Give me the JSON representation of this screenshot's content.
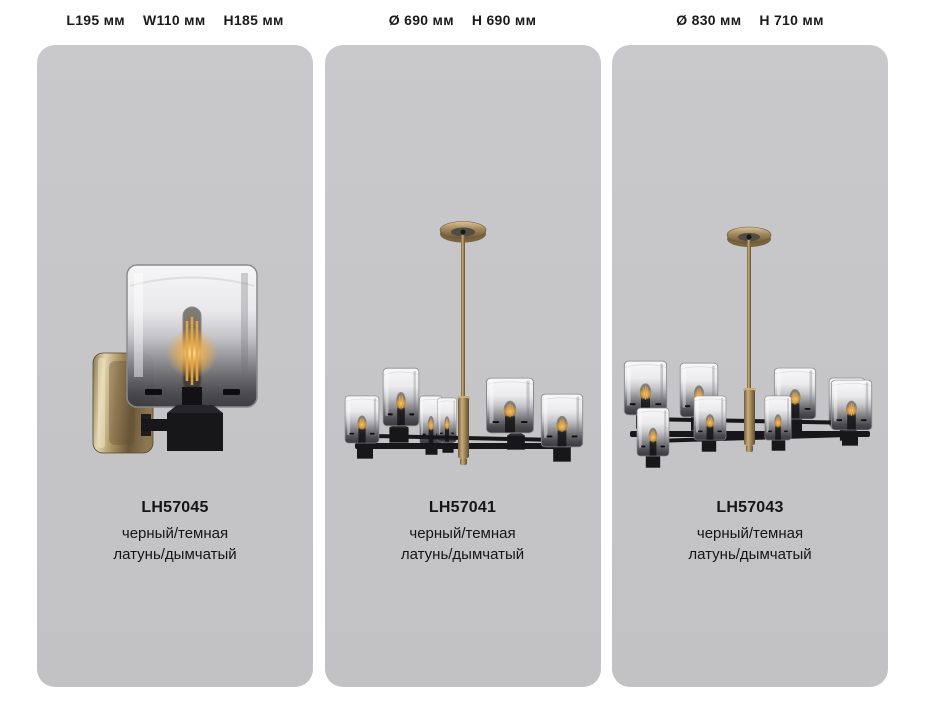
{
  "page": {
    "background_color": "#ffffff",
    "card_background_color": "#c6c6c8"
  },
  "products": [
    {
      "image": "wall-sconce-one-light",
      "dimensions": [
        "L195 мм",
        "W110 мм",
        "H185 мм"
      ],
      "code": "LH57045",
      "finish_line1": "черный/темная",
      "finish_line2": "латунь/дымчатый"
    },
    {
      "image": "chandelier-six-light",
      "dimensions": [
        "Ø 690 мм",
        "H 690 мм"
      ],
      "code": "LH57041",
      "finish_line1": "черный/темная",
      "finish_line2": "латунь/дымчатый"
    },
    {
      "image": "chandelier-eight-light",
      "dimensions": [
        "Ø 830 мм",
        "H 710 мм"
      ],
      "code": "LH57043",
      "finish_line1": "черный/темная",
      "finish_line2": "латунь/дымчатый"
    }
  ],
  "colors": {
    "text": "#1b1b1d",
    "brass": "#9c8254",
    "brass_light": "#d9c294",
    "black_metal": "#17171a",
    "glass_smoke": "#3a3a3e",
    "filament_glow": "#eaa73f"
  }
}
